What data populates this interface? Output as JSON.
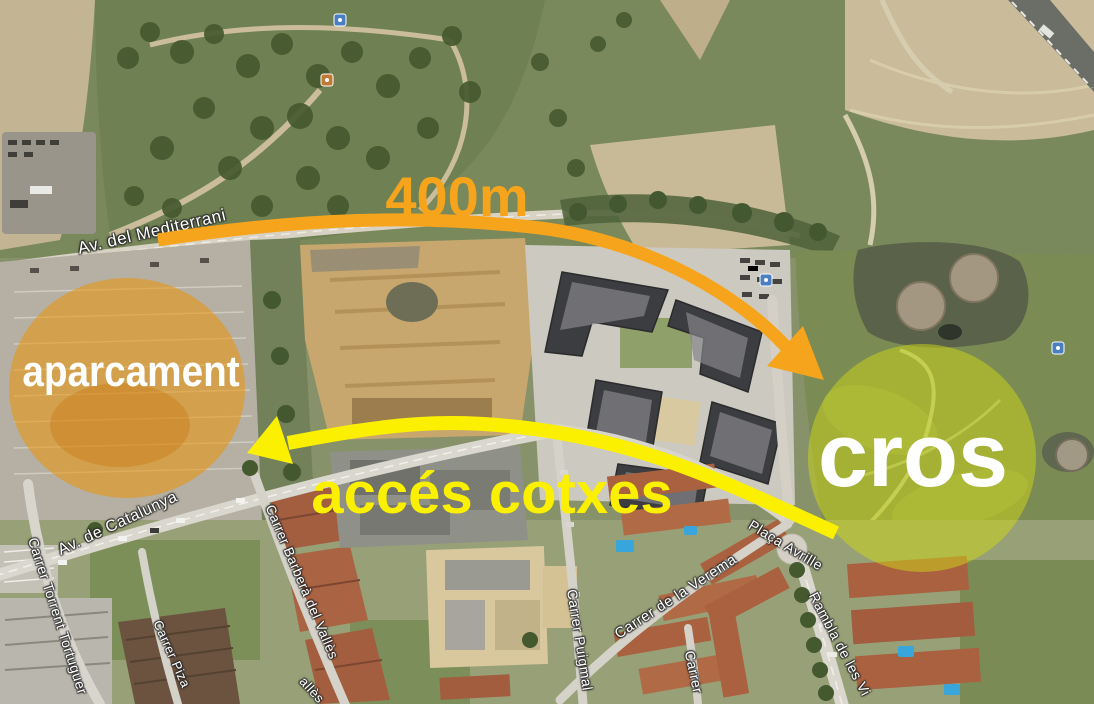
{
  "map": {
    "street_labels": [
      {
        "id": "av-del-mediterrani",
        "text": "Av. del Mediterrani"
      },
      {
        "id": "av-de-catalunya",
        "text": "Av. de Catalunya"
      },
      {
        "id": "carrer-torrent-tortuguer",
        "text": "Carrer Torrent Tortuguer"
      },
      {
        "id": "carrer-piza-partial",
        "text": "Carrer Piza"
      },
      {
        "id": "carrer-barbera-del-valles",
        "text": "Carrer Barberà del Vallès"
      },
      {
        "id": "carrer-puigmal",
        "text": "Carrer Puigmal"
      },
      {
        "id": "carrer-de-la-verema",
        "text": "Carrer de la Verema"
      },
      {
        "id": "carrer-partial",
        "text": "Carrer"
      },
      {
        "id": "placa-avrille",
        "text": "Plaça Avrille"
      },
      {
        "id": "rambla-de-les-vi-partial",
        "text": "Rambla de les Vi"
      },
      {
        "id": "valles-partial",
        "text": "allès"
      }
    ],
    "icons": [
      {
        "name": "poi-marker-icon",
        "count": 4
      }
    ]
  },
  "annotations": {
    "parking_label": "aparcament",
    "cros_label": "cros",
    "distance_label": "400m",
    "access_label": "accés cotxes",
    "arrows": [
      {
        "name": "distance-arrow",
        "color": "orange",
        "label": "400m"
      },
      {
        "name": "car-access-arrow",
        "color": "yellow",
        "label": "accés cotxes"
      }
    ],
    "colors": {
      "orange": "#F7A41D",
      "yellow": "#FAF000",
      "label_white": "#FFFFFF",
      "parking_highlight": "rgba(235,148,8,0.55)",
      "cross_highlight": "rgba(205,215,20,0.5)"
    }
  }
}
